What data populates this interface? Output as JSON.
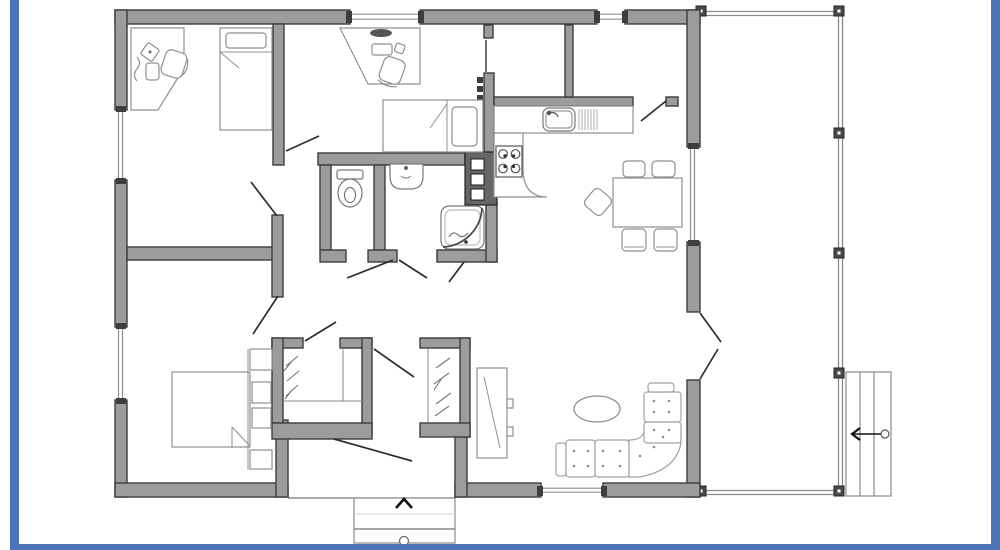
{
  "page": {
    "title": "House floor plan drawing",
    "description": "Black-and-white architectural floor plan of a single-storey house with a side deck and stairs, framed by a blue border"
  },
  "colors": {
    "background": "#ffffff",
    "frame": "#4a73b8",
    "wall_fill": "#9c9c9c",
    "wall_stroke": "#3d3d3d",
    "window_line": "#8f8f8f",
    "furniture_line": "#909090",
    "sofa_line": "#a2a2a2",
    "fixture_line": "#767676",
    "door_line": "#2e2e2e",
    "arrow": "#111111",
    "heater_fill": "#666666",
    "railing_line": "#8a8a8a",
    "post_fill": "#4a4a4a"
  },
  "plan": {
    "rooms": [
      {
        "id": "bedroom-1",
        "label": "Bedroom / office (top-left)",
        "furniture": [
          "corner desk",
          "desk chair",
          "single bed"
        ]
      },
      {
        "id": "bedroom-2",
        "label": "Bedroom / office (top-middle)",
        "furniture": [
          "desk",
          "desk chair",
          "single bed",
          "walk-in closet"
        ]
      },
      {
        "id": "pantry",
        "label": "Pantry / storage (top-right)",
        "furniture": []
      },
      {
        "id": "kitchen",
        "label": "Kitchen",
        "furniture": [
          "L-shaped counter",
          "sink with drainer",
          "4-burner stove"
        ]
      },
      {
        "id": "dining",
        "label": "Dining area",
        "furniture": [
          "dining table",
          "5 chairs"
        ]
      },
      {
        "id": "wc",
        "label": "WC",
        "furniture": [
          "toilet"
        ]
      },
      {
        "id": "bathroom",
        "label": "Bathroom",
        "furniture": [
          "wash basin"
        ]
      },
      {
        "id": "shower",
        "label": "Shower room",
        "furniture": [
          "corner shower",
          "water heater"
        ]
      },
      {
        "id": "hallway",
        "label": "Hallway",
        "furniture": []
      },
      {
        "id": "bedroom-3",
        "label": "Bedroom (bottom-left)",
        "furniture": [
          "double bed",
          "bedside storage cubes"
        ]
      },
      {
        "id": "closet-left",
        "label": "Wardrobe closet (left)",
        "furniture": [
          "hanging rail with hangers"
        ]
      },
      {
        "id": "closet-right",
        "label": "Wardrobe closet (right)",
        "furniture": [
          "hanging rail with hangers"
        ]
      },
      {
        "id": "living",
        "label": "Living room",
        "furniture": [
          "corner sofa",
          "oval coffee table",
          "TV cabinet"
        ]
      }
    ],
    "outdoor": [
      {
        "id": "deck",
        "label": "Side deck with railing",
        "details": "railing with posts along top, right and bottom edges"
      },
      {
        "id": "deck-stairs",
        "label": "Deck stairs",
        "details": "3 treads, direction arrow pointing left onto deck"
      },
      {
        "id": "entry-steps",
        "label": "Front entry steps",
        "details": "direction arrow pointing up into hallway"
      }
    ],
    "windows": 6,
    "interior_doors": 10,
    "exterior_doors": [
      "front entry door",
      "double patio door to deck"
    ]
  }
}
